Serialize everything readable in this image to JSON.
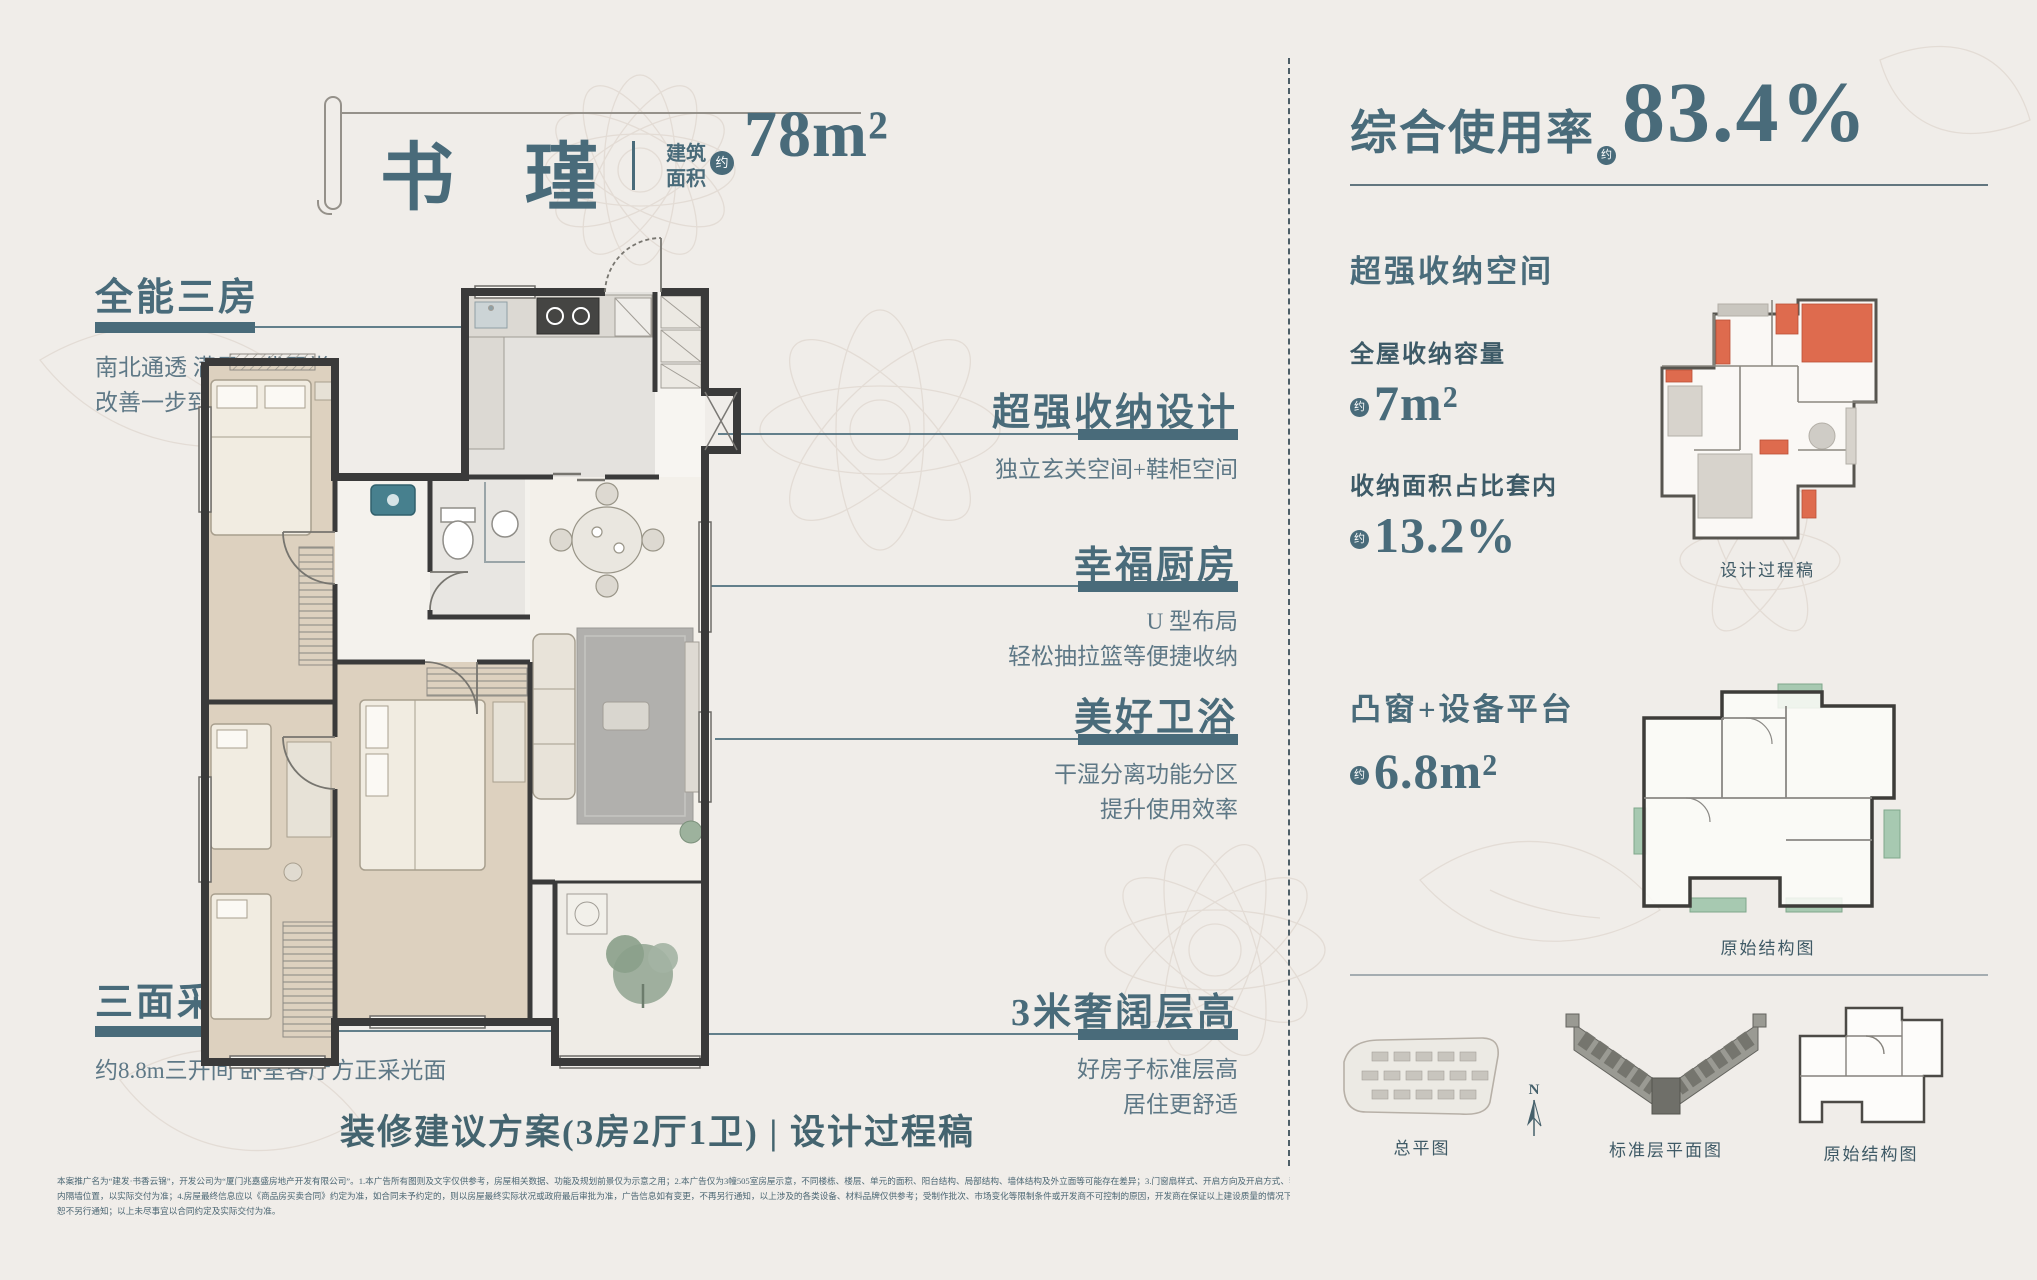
{
  "colors": {
    "background": "#f0ede9",
    "accent": "#496b7a",
    "text_muted": "#5e7886",
    "wall": "#3a3a3a",
    "highlight_red": "#de6b4e",
    "highlight_green": "#a7c9b1"
  },
  "title_block": {
    "name": "书 瑾",
    "area_label_line1": "建筑",
    "area_label_line2": "面积",
    "approx": "约",
    "area_value": "78m²"
  },
  "callouts": [
    {
      "title": "全能三房",
      "desc_lines": [
        "南北通透 满足三代同堂",
        "改善一步到位"
      ]
    },
    {
      "title": "超强收纳设计",
      "desc_lines": [
        "独立玄关空间+鞋柜空间"
      ]
    },
    {
      "title": "幸福厨房",
      "desc_lines": [
        "U 型布局",
        "轻松抽拉篮等便捷收纳"
      ]
    },
    {
      "title": "美好卫浴",
      "desc_lines": [
        "干湿分离功能分区",
        "提升使用效率"
      ]
    },
    {
      "title": "三面采光",
      "desc_lines": [
        "约8.8m三开间 卧室客厅方正采光面"
      ]
    },
    {
      "title": "3米奢阔层高",
      "desc_lines": [
        "好房子标准层高",
        "居住更舒适"
      ]
    }
  ],
  "plan_heading": "装修建议方案(3房2厅1卫) | 设计过程稿",
  "disclaimer": {
    "lines": [
      "本案推广名为“建发·书香云锦”，开发公司为“厦门兆嘉盛房地产开发有限公司”。1.本广告所有图则及文字仅供参考，房屋相关数据、功能及规划前景仅为示意之用；2.本广告仅为3幢505室房屋示意，不同楼栋、楼层、单元的面积、阳台结构、局部结构、墙体结构及外立面等可能存在差异；3.门窗扇样式、开启方向及开启方式、套内外设备管道、管井及空调机位位置、",
      "内隔墙位置，以实际交付为准；4.房屋最终信息应以《商品房买卖合同》约定为准，如合同未予约定的，则以房屋最终实际状况或政府最后审批为准，广告信息如有变更，不再另行通知，以上涉及的各类设备、材料品牌仅供参考；受制作批次、市场变化等限制条件或开发商不可控制的原因，开发商在保证以上建设质量的情况下可能进行更换品牌、型号、材质等，如有变动，",
      "恕不另行通知；以上未尽事宜以合同约定及实际交付为准。"
    ]
  },
  "right_panel": {
    "usage": {
      "label": "综合使用率",
      "approx": "约",
      "value": "83.4%"
    },
    "storage": {
      "heading": "超强收纳空间",
      "metrics": [
        {
          "label": "全屋收纳容量",
          "approx": "约",
          "value": "7m²"
        },
        {
          "label": "收纳面积占比套内",
          "approx": "约",
          "value": "13.2%"
        }
      ],
      "plan_caption": "设计过程稿"
    },
    "bay": {
      "heading": "凸窗+设备平台",
      "approx": "约",
      "value": "6.8m²",
      "plan_caption": "原始结构图"
    },
    "bottom_plans": [
      {
        "caption": "总平图"
      },
      {
        "caption": "标准层平面图"
      },
      {
        "caption": "原始结构图"
      }
    ],
    "compass_label": "N"
  }
}
